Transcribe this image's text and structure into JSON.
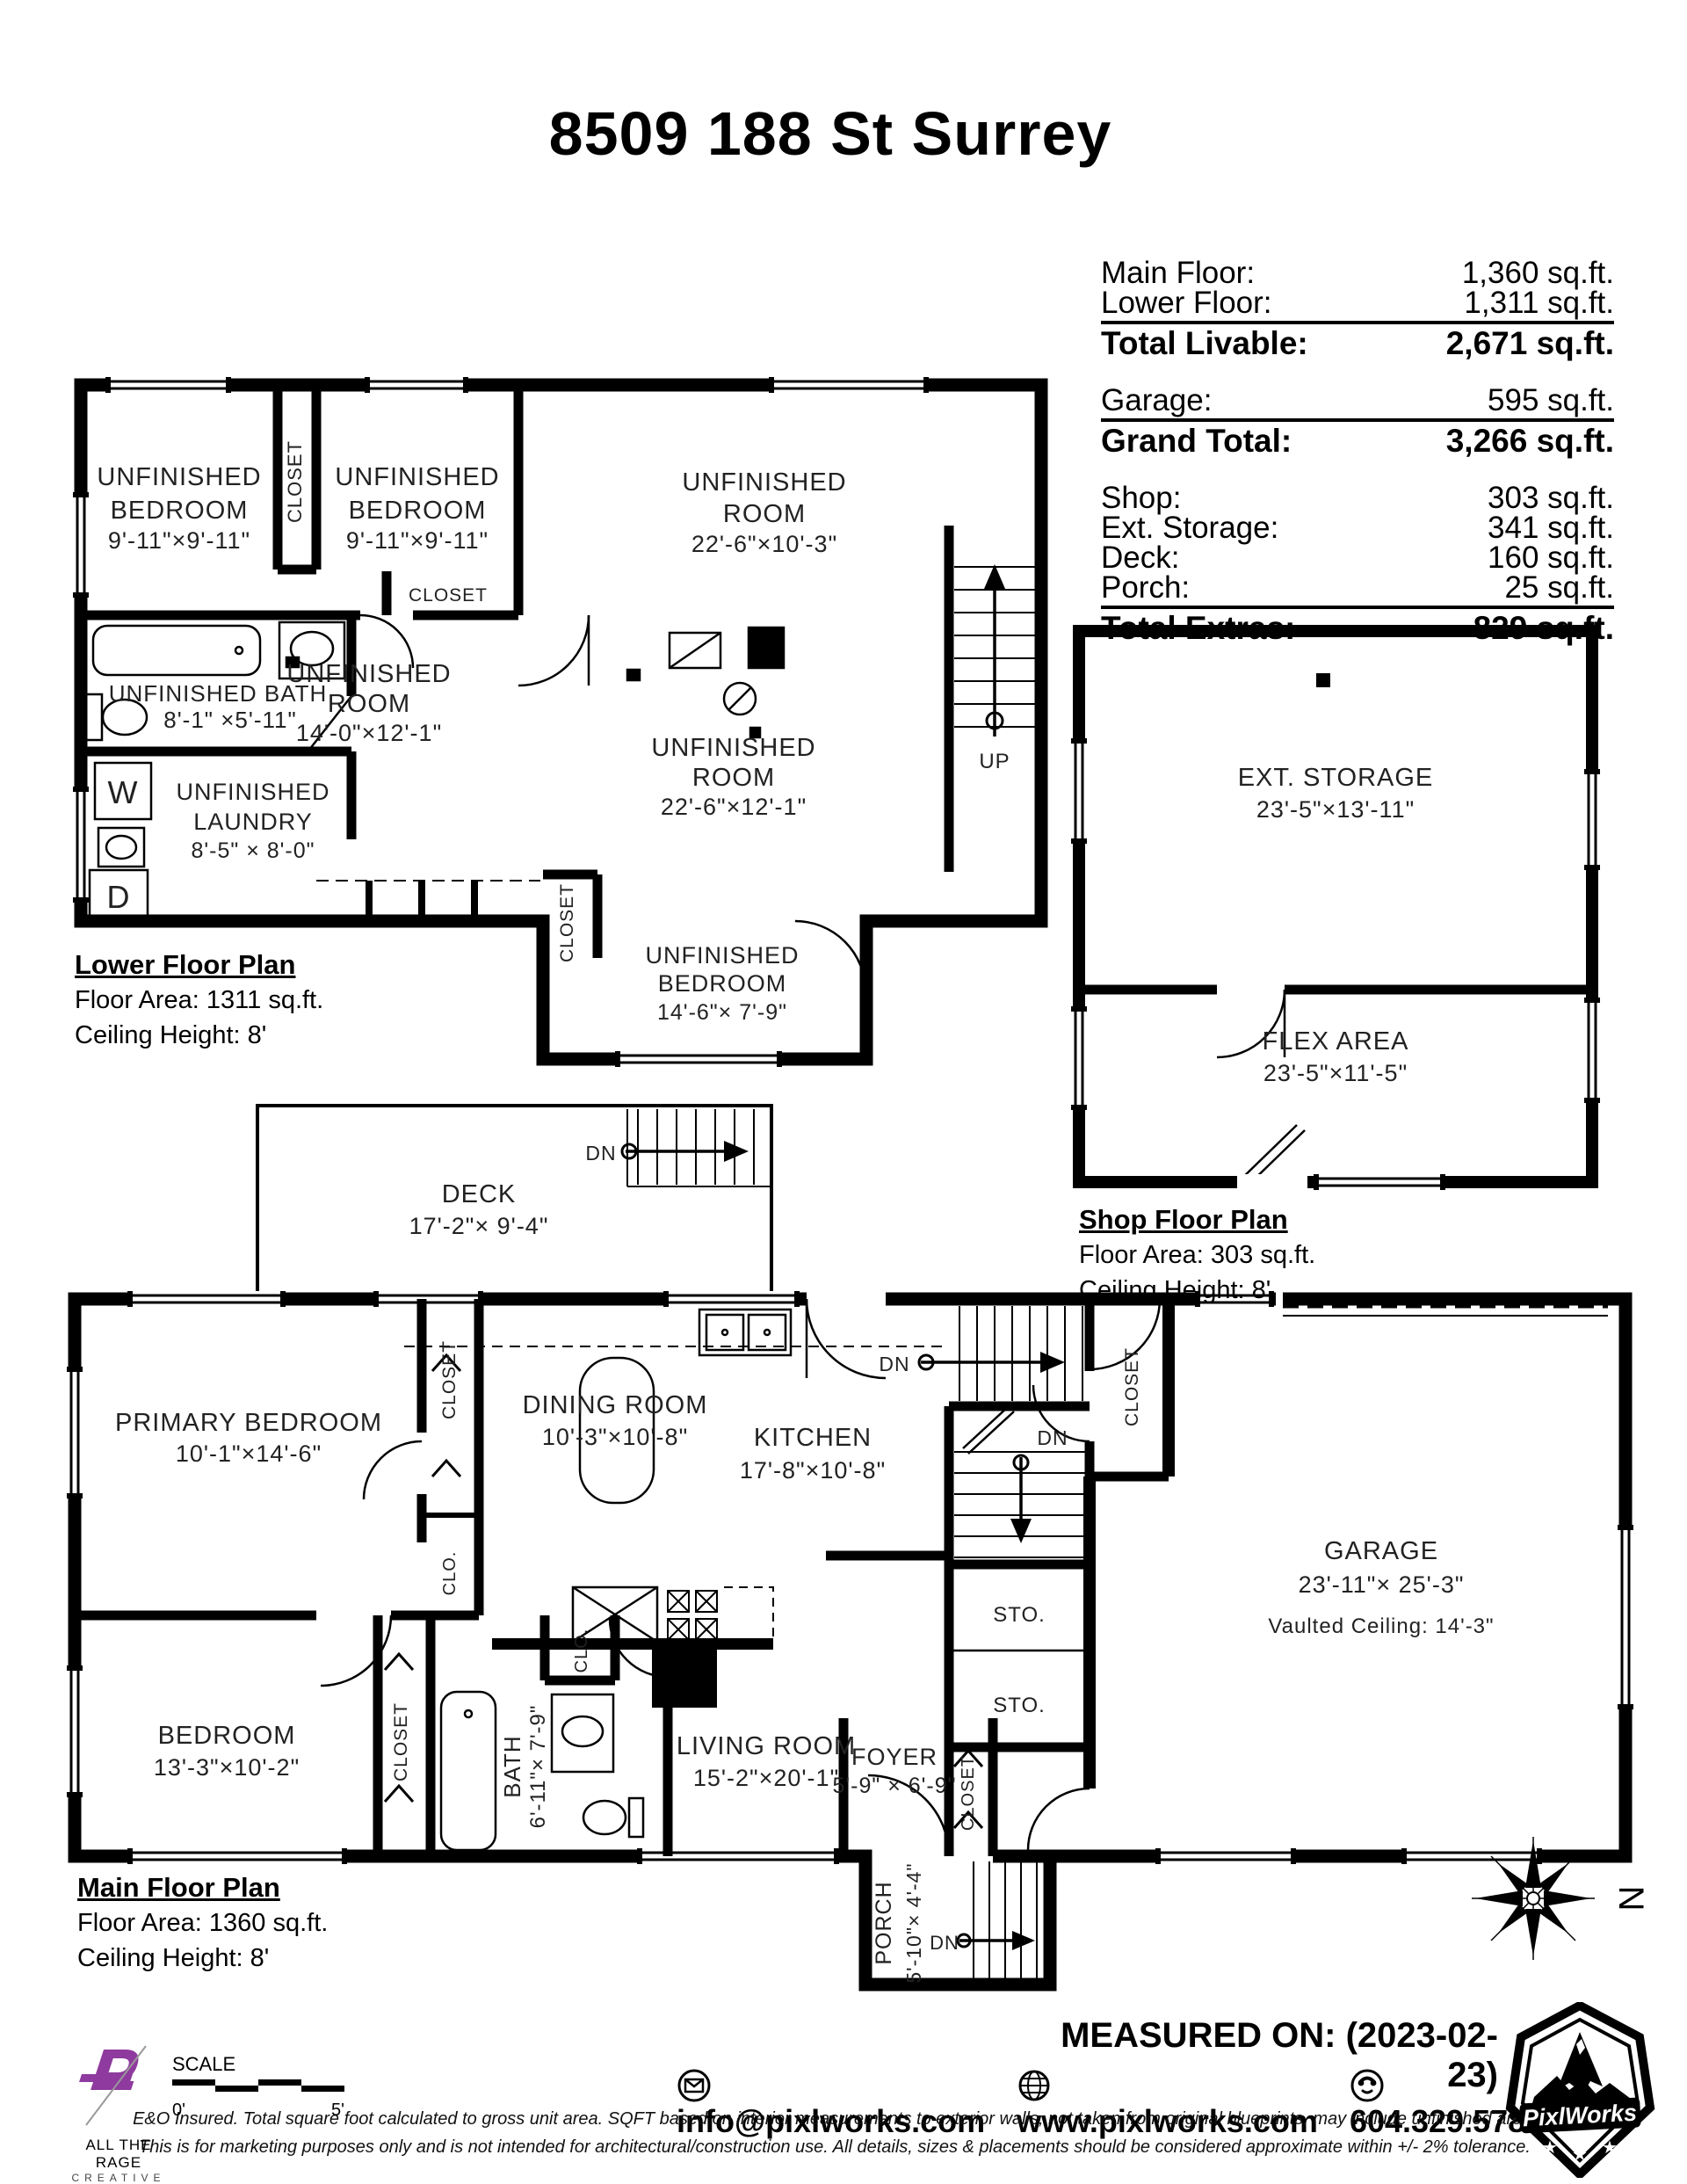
{
  "title": "8509 188 St Surrey",
  "colors": {
    "ink": "#000000",
    "accent_purple": "#8e3a9e"
  },
  "area_table": {
    "rows": [
      {
        "label": "Main Floor:",
        "value": "1,360 sq.ft."
      },
      {
        "label": "Lower Floor:",
        "value": "1,311 sq.ft."
      },
      {
        "label": "Total Livable:",
        "value": "2,671 sq.ft."
      },
      {
        "label": "Garage:",
        "value": "595 sq.ft."
      },
      {
        "label": "Grand Total:",
        "value": "3,266 sq.ft."
      },
      {
        "label": "Shop:",
        "value": "303 sq.ft."
      },
      {
        "label": "Ext. Storage:",
        "value": "341 sq.ft."
      },
      {
        "label": "Deck:",
        "value": "160 sq.ft."
      },
      {
        "label": "Porch:",
        "value": "25 sq.ft."
      },
      {
        "label": "Total Extras:",
        "value": "829 sq.ft."
      }
    ]
  },
  "plans": {
    "lower": {
      "caption": [
        "Lower Floor Plan",
        "Floor Area: 1311 sq.ft.",
        "Ceiling Height: 8'"
      ],
      "rooms": {
        "bed1": [
          "UNFINISHED",
          "BEDROOM",
          "9'-11\"×9'-11\""
        ],
        "bed2": [
          "UNFINISHED",
          "BEDROOM",
          "9'-11\"×9'-11\""
        ],
        "room_tr": [
          "UNFINISHED",
          "ROOM",
          "22'-6\"×10'-3\""
        ],
        "room_mid": [
          "UNFINISHED",
          "ROOM",
          "14'-0\"×12'-1\""
        ],
        "room_br": [
          "UNFINISHED",
          "ROOM",
          "22'-6\"×12'-1\""
        ],
        "bath": [
          "UNFINISHED BATH",
          "8'-1\" ×5'-11\""
        ],
        "laundry": [
          "UNFINISHED",
          "LAUNDRY",
          "8'-5\" × 8'-0\""
        ],
        "bed3": [
          "UNFINISHED",
          "BEDROOM",
          "14'-6\"× 7'-9\""
        ]
      },
      "labels": {
        "closet1": "CLOSET",
        "closet2": "CLOSET",
        "closet3": "CLOSET",
        "up": "UP",
        "washer": "W",
        "dryer": "D"
      }
    },
    "shop": {
      "caption": [
        "Shop Floor Plan",
        "Floor Area: 303 sq.ft.",
        "Ceiling Height: 8'"
      ],
      "rooms": {
        "ext_storage": [
          "EXT. STORAGE",
          "23'-5\"×13'-11\""
        ],
        "flex": [
          "FLEX AREA",
          "23'-5\"×11'-5\""
        ]
      }
    },
    "main": {
      "caption": [
        "Main Floor Plan",
        "Floor Area: 1360 sq.ft.",
        "Ceiling Height: 8'"
      ],
      "rooms": {
        "deck": [
          "DECK",
          "17'-2\"× 9'-4\""
        ],
        "primary": [
          "PRIMARY BEDROOM",
          "10'-1\"×14'-6\""
        ],
        "dining": [
          "DINING ROOM",
          "10'-3\"×10'-8\""
        ],
        "kitchen": [
          "KITCHEN",
          "17'-8\"×10'-8\""
        ],
        "garage": [
          "GARAGE",
          "23'-11\"× 25'-3\"",
          "Vaulted Ceiling: 14'-3\""
        ],
        "bedroom": [
          "BEDROOM",
          "13'-3\"×10'-2\""
        ],
        "bath": [
          "BATH",
          "6'-11\"× 7'-9\""
        ],
        "living": [
          "LIVING ROOM",
          "15'-2\"×20'-1\""
        ],
        "foyer": [
          "FOYER",
          "5'-9\" × 6'-9\""
        ],
        "porch": [
          "PORCH",
          "5'-10\"× 4'-4\""
        ]
      },
      "labels": {
        "closet_p": "CLOSET",
        "clo_p": "CLO.",
        "closet_b": "CLOSET",
        "clo_b": "CLO.",
        "closet_g": "CLOSET",
        "closet_f": "CLOSET",
        "sto1": "STO.",
        "sto2": "STO.",
        "dn_deck": "DN",
        "dn_stairs_up": "DN",
        "dn_stairs_low": "DN",
        "dn_porch": "DN"
      }
    }
  },
  "compass": {
    "north": "N"
  },
  "scale": {
    "label": "SCALE",
    "start": "0'",
    "end": "5'"
  },
  "footer": {
    "measured_on": "MEASURED ON: (2023-02-23)",
    "email": "info@pixlworks.com",
    "website": "www.pixlworks.com",
    "phone": "604.329.5788",
    "disclaimer1": "E&O Insured.  Total square foot calculated to gross unit area. SQFT based on interior measurements to exterior walls, not taken from original blueprints, may include unfinished area.",
    "disclaimer2": "This is for marketing purposes only and is not intended for architectural/construction use.  All details, sizes & placements should be considered approximate within +/- 2%  tolerance.",
    "atr_line1": "ALL THE RAGE",
    "atr_line2": "CREATIVE",
    "pixlworks": "PixlWorks"
  }
}
